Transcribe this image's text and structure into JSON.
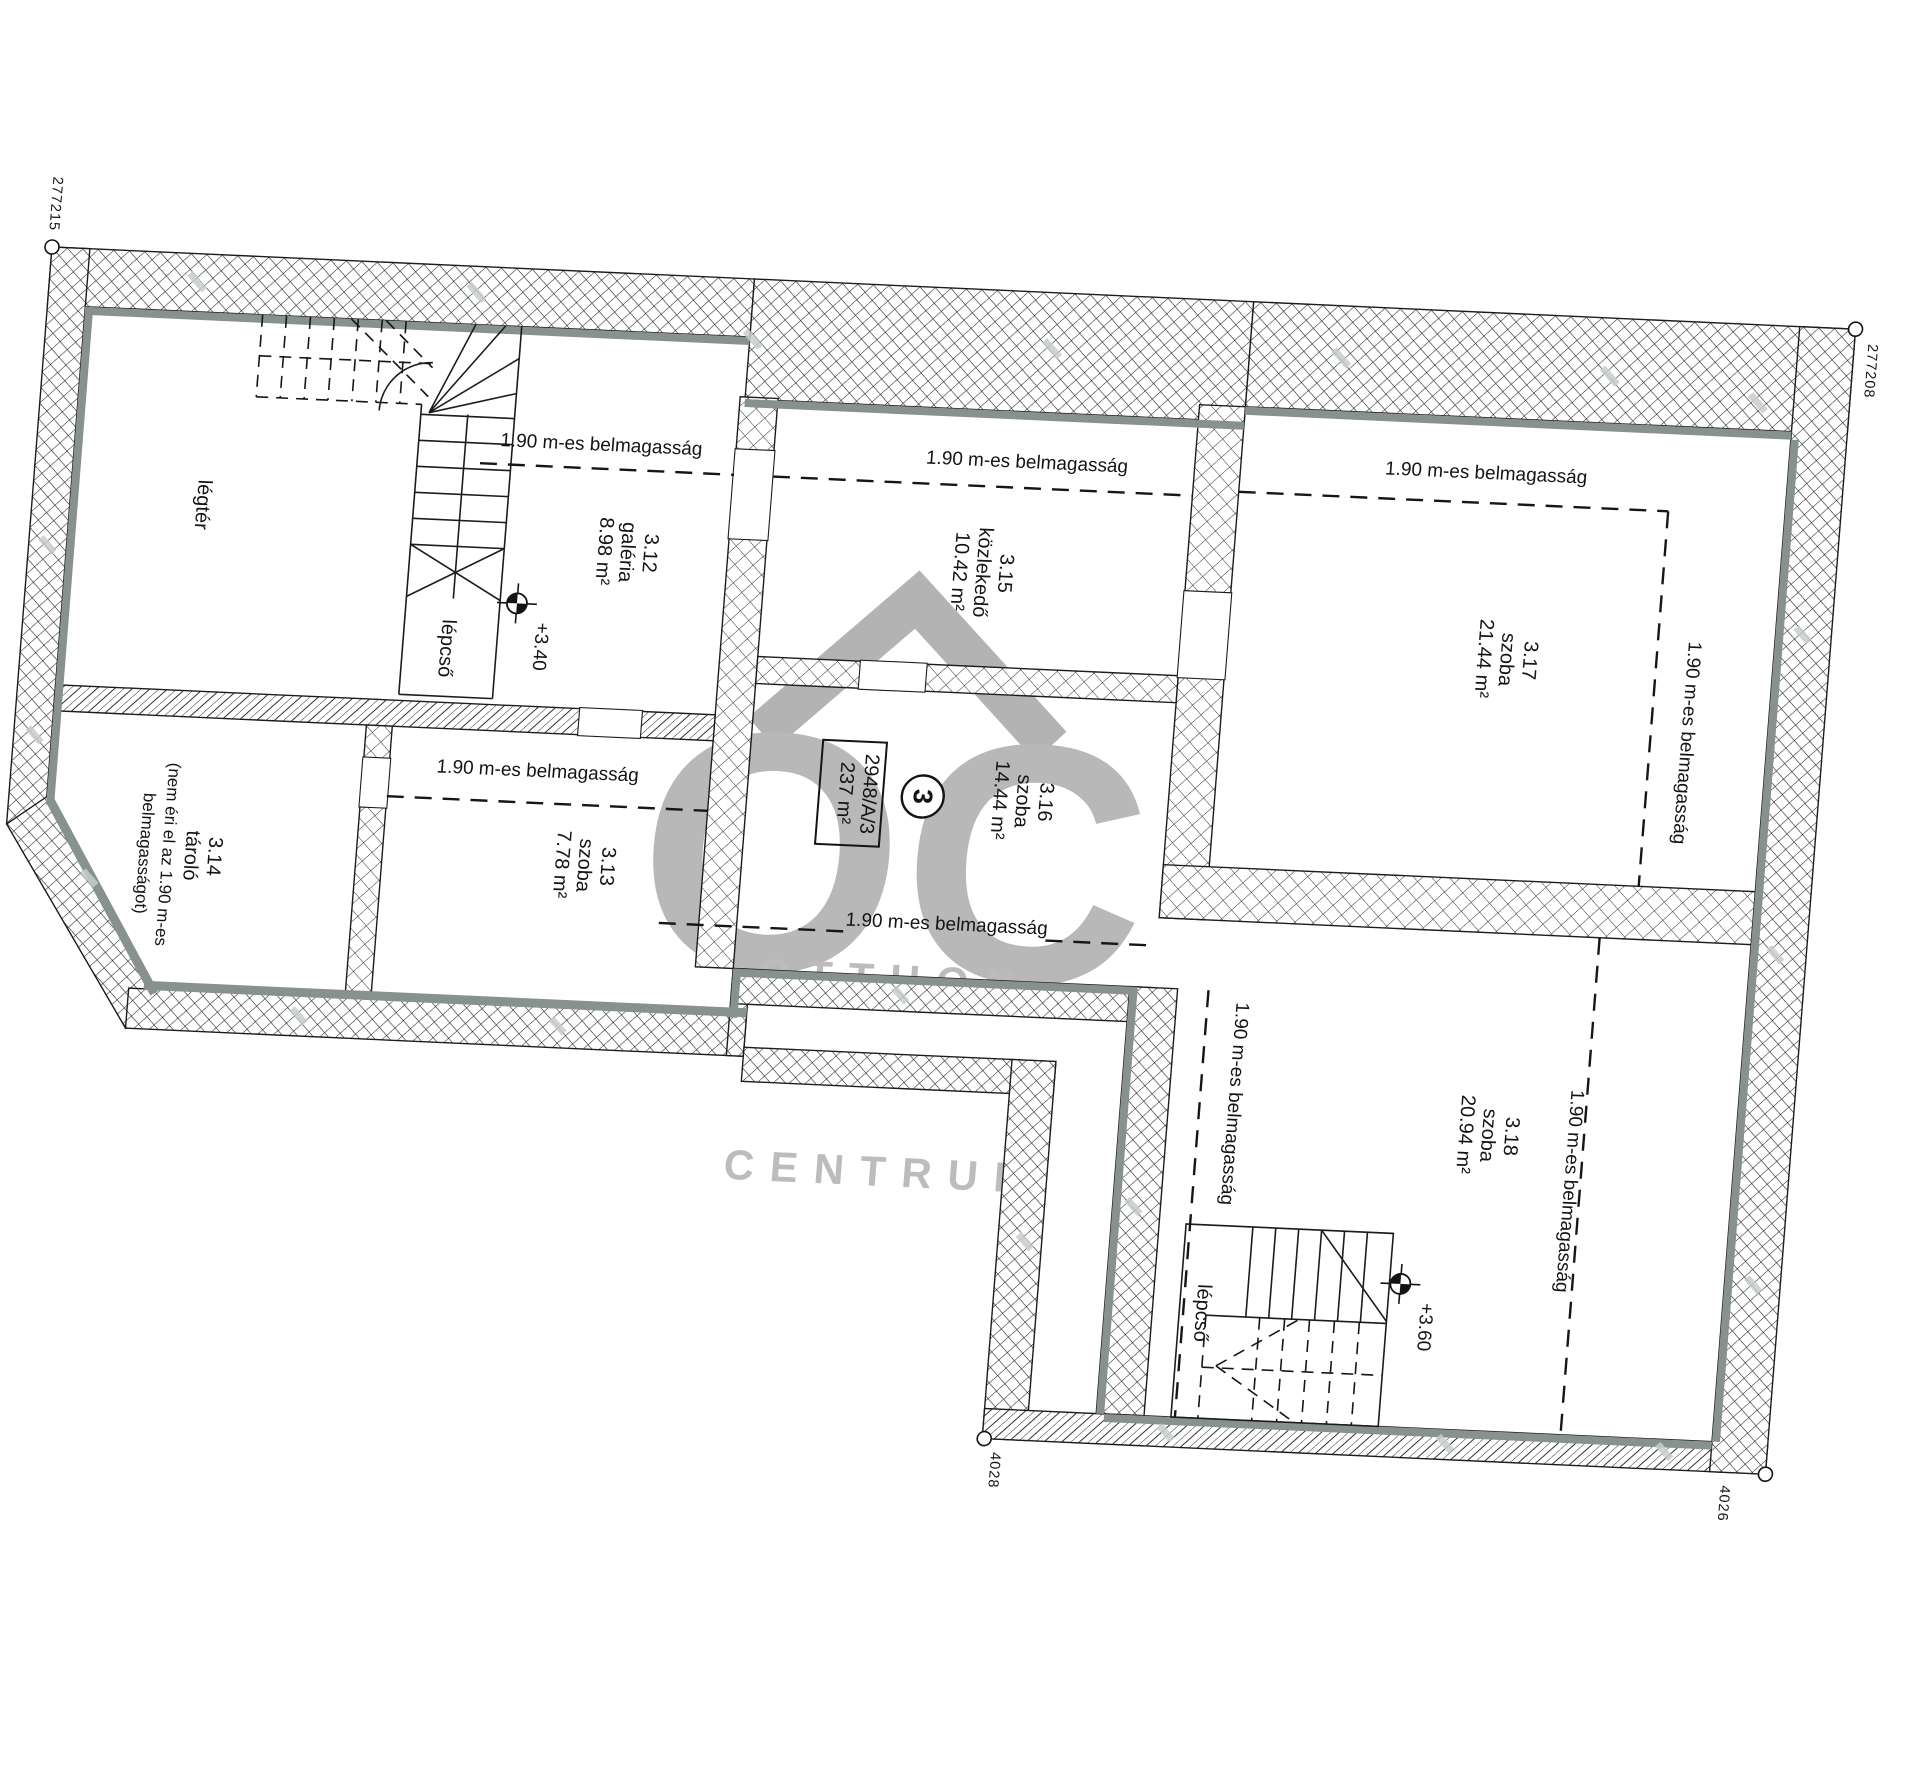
{
  "colors": {
    "wall_line": "#1c1c1c",
    "accent_gray": "#87928f",
    "watermark_gray": "#b8b8b8"
  },
  "corner_labels": {
    "top_left": "277215",
    "top_right": "277208",
    "bottom_left": "4028",
    "bottom_right": "4026"
  },
  "parcel_badge": {
    "code": "2948/A/3",
    "area": "237 m²",
    "unit": "3"
  },
  "height_note": "1.90 m-es belmagasság",
  "levels": {
    "gallery": "+3.40",
    "lower": "+3.60"
  },
  "stair_label": "lépcső",
  "void_label": "légtér",
  "rooms": [
    {
      "id": "3.12",
      "name": "galéria",
      "area": "8.98 m²"
    },
    {
      "id": "3.13",
      "name": "szoba",
      "area": "7.78 m²"
    },
    {
      "id": "3.14",
      "name": "tároló",
      "note1": "(nem éri el az 1.90 m-es",
      "note2": "belmagasságot)"
    },
    {
      "id": "3.15",
      "name": "közlekedő",
      "area": "10.42 m²"
    },
    {
      "id": "3.16",
      "name": "szoba",
      "area": "14.44 m²"
    },
    {
      "id": "3.17",
      "name": "szoba",
      "area": "21.44 m²"
    },
    {
      "id": "3.18",
      "name": "szoba",
      "area": "20.94 m²"
    }
  ],
  "watermark": {
    "monogram": "OC",
    "line1": "OTTHON",
    "line2": "CENTRUM"
  }
}
